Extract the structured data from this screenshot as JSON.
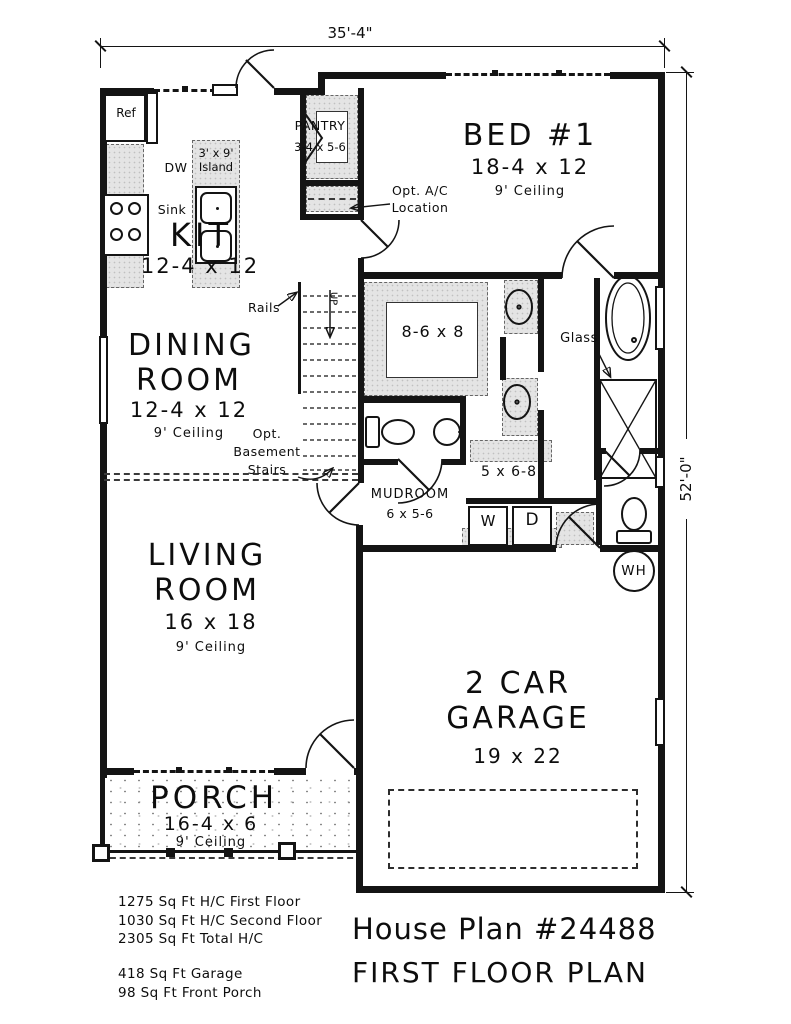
{
  "title": {
    "line1": "House Plan #24488",
    "line2": "FIRST FLOOR PLAN"
  },
  "dimensions": {
    "width": "35'-4\"",
    "height": "52'-0\""
  },
  "rooms": {
    "kitchen": {
      "name": "KIT",
      "size": "12-4 x 12"
    },
    "dining": {
      "name": "DINING ROOM",
      "size": "12-4 x 12",
      "ceiling": "9' Ceiling"
    },
    "living": {
      "name": "LIVING ROOM",
      "size": "16 x 18",
      "ceiling": "9' Ceiling"
    },
    "bed1": {
      "name": "BED #1",
      "size": "18-4 x 12",
      "ceiling": "9' Ceiling"
    },
    "pantry": {
      "name": "PANTRY",
      "size": "3-4 x 5-6"
    },
    "walk_in_closet": {
      "size": "8-6 x 8"
    },
    "bath_hall": {
      "size": "5 x 6-8"
    },
    "mudroom": {
      "name": "MUDROOM",
      "size": "6 x 5-6"
    },
    "garage": {
      "name": "2 CAR GARAGE",
      "size": "19 x 22"
    },
    "porch": {
      "name": "PORCH",
      "size": "16-4 x 6",
      "ceiling": "9' Ceiling"
    }
  },
  "fixtures": {
    "refrigerator": "Ref",
    "dishwasher": "DW",
    "island_line1": "3' x 9'",
    "island_line2": "Island",
    "sink": "Sink",
    "washer": "W",
    "dryer": "D",
    "water_heater": "WH",
    "stairs_up": "UP"
  },
  "annotations": {
    "rails": "Rails",
    "opt_ac_line1": "Opt. A/C",
    "opt_ac_line2": "Location",
    "opt_basement_line1": "Opt.",
    "opt_basement_line2": "Basement",
    "opt_basement_line3": "Stairs",
    "glass": "Glass"
  },
  "footer": {
    "lines": [
      "1275 Sq Ft H/C First Floor",
      "1030 Sq Ft H/C Second Floor",
      "2305 Sq Ft Total H/C",
      "418 Sq Ft Garage",
      "98 Sq Ft Front Porch"
    ]
  }
}
